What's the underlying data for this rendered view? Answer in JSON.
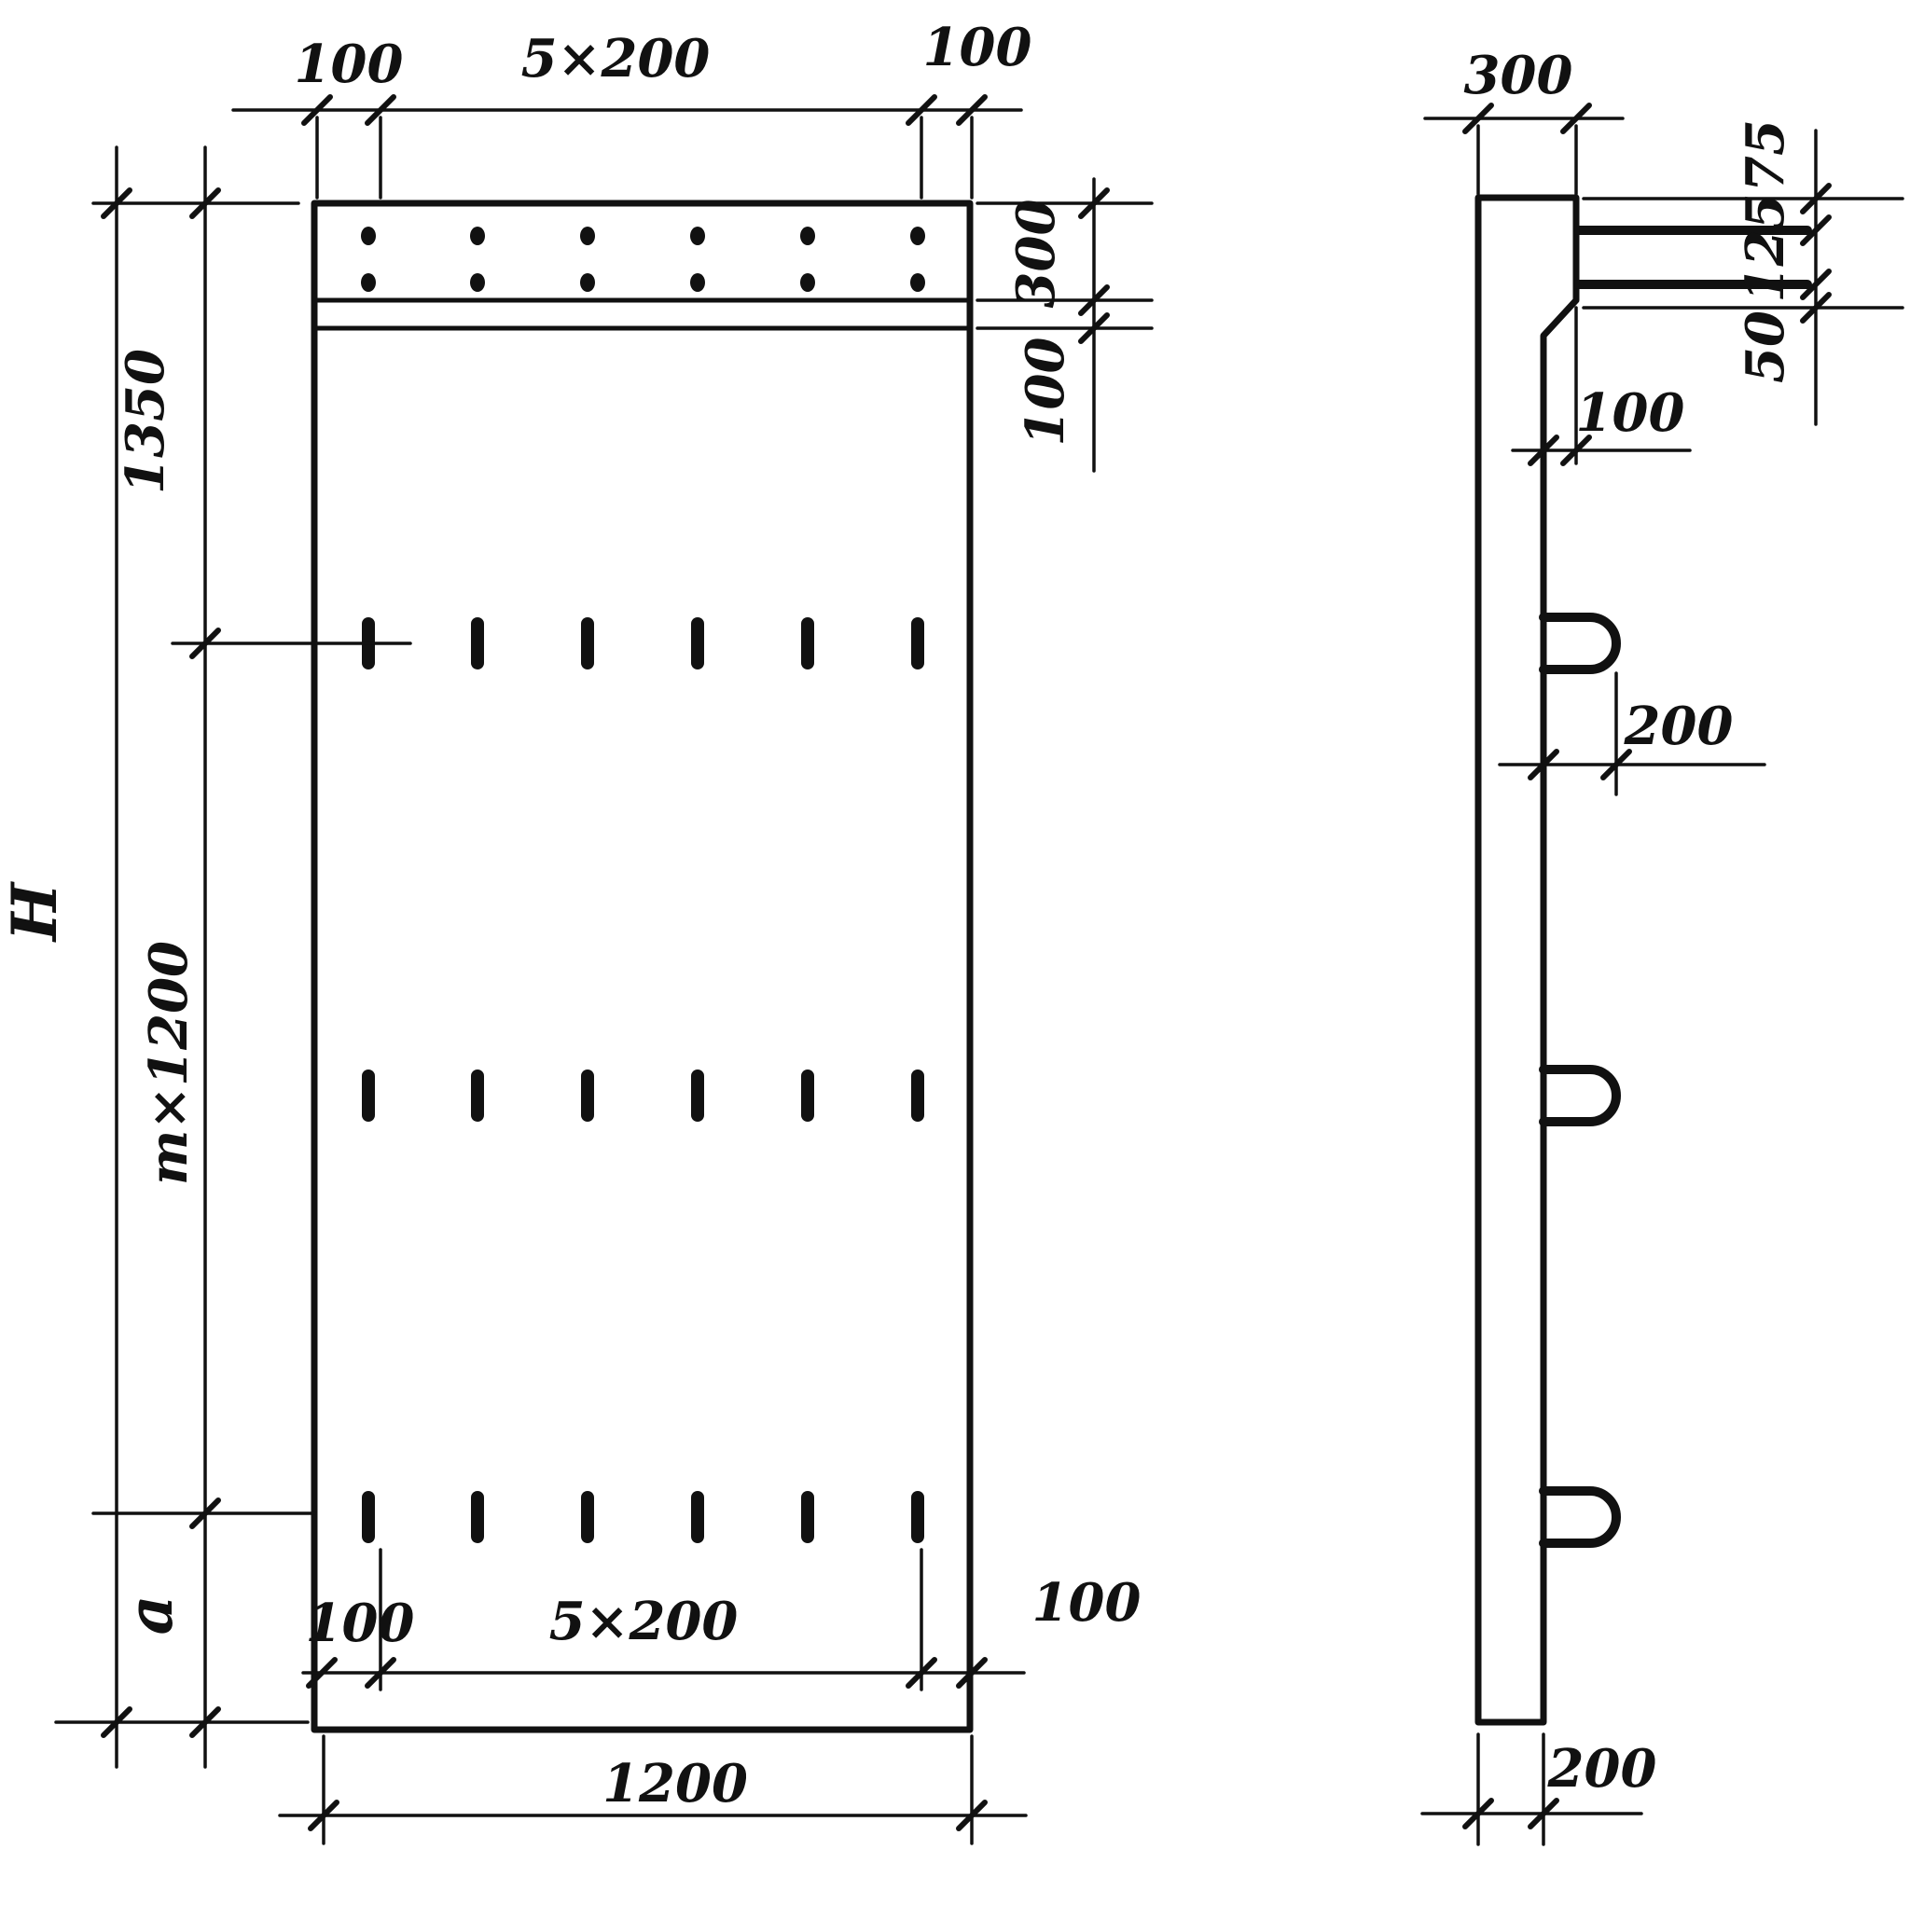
{
  "front_view": {
    "top_dims": {
      "left": "100",
      "middle": "5×200",
      "right": "100"
    },
    "right_dims": {
      "band": "300",
      "strip": "100"
    },
    "left_dims": {
      "top": "1350",
      "middle": "m×1200",
      "bottom": "a",
      "overall": "H"
    },
    "bottom_dims": {
      "left": "100",
      "middle": "5×200",
      "right": "100",
      "overall": "1200"
    },
    "anchor_grid": {
      "columns": 6,
      "dot_rows": 2,
      "dash_rows": 3
    }
  },
  "side_view": {
    "top_dim": "300",
    "right_dims": {
      "top": "75",
      "middle": "125",
      "bottom": "50"
    },
    "step_dim": "100",
    "loop_dim": "200",
    "bottom_dim": "200",
    "loop_count": 3
  },
  "colors": {
    "ink": "#111111",
    "background": "#ffffff"
  }
}
